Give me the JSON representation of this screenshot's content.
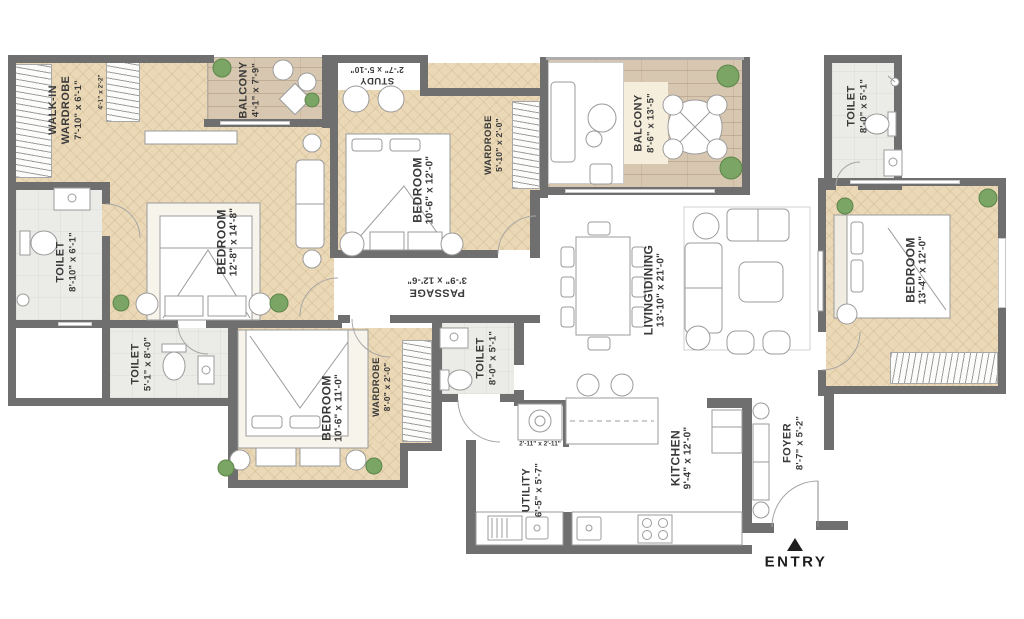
{
  "palette": {
    "wall": "#6f6f6f",
    "wood": "#ead8b6",
    "deck": "#d8c7b0",
    "tile": "#ebebe7",
    "cream": "#f5eedc",
    "plant": "#7aa564",
    "ink": "#3a3a3a"
  },
  "rooms": {
    "walk_in_wardrobe": {
      "name": "WALK-IN\nWARDROBE",
      "dims": "7'-10\" x 6'-1\""
    },
    "wiw_closet": {
      "dims": "4'-1\" x 2'-2\""
    },
    "toilet_master": {
      "name": "TOILET",
      "dims": "8'-10\" x 6'-1\""
    },
    "bedroom_master": {
      "name": "BEDROOM",
      "dims": "12'-8\" x 14'-8\""
    },
    "balcony_1": {
      "name": "BALCONY",
      "dims": "4'-1\" x 7'-9\""
    },
    "study": {
      "name": "STUDY",
      "dims": "2'-7\" x 5'-10\""
    },
    "bedroom_2": {
      "name": "BEDROOM",
      "dims": "10'-6\" x 12'-0\""
    },
    "wardrobe_2": {
      "name": "WARDROBE",
      "dims": "5'-10\" x 2'-0\""
    },
    "balcony_2": {
      "name": "BALCONY",
      "dims": "8'-6\" x 13'-5\""
    },
    "toilet_top_right": {
      "name": "TOILET",
      "dims": "8'-0\" x 5'-1\""
    },
    "bedroom_3": {
      "name": "BEDROOM",
      "dims": "13'-4\" x 12'-0\""
    },
    "living_dining": {
      "name": "LIVING\\DINING",
      "dims": "13'-10\" x 21'-0\""
    },
    "passage": {
      "name": "PASSAGE",
      "dims": "3'-9\" x 12'-6\""
    },
    "toilet_3": {
      "name": "TOILET",
      "dims": "5'-1\" x 8'-0\""
    },
    "bedroom_4": {
      "name": "BEDROOM",
      "dims": "10'-6\" x 11'-0\""
    },
    "wardrobe_4": {
      "name": "WARDROBE",
      "dims": "8'-0\" x 2'-0\""
    },
    "toilet_4": {
      "name": "TOILET",
      "dims": "8'-0\" x 5'-1\""
    },
    "washer_nook": {
      "dims": "2'-11\" x 2'-11\""
    },
    "utility": {
      "name": "UTILITY",
      "dims": "6'-5\" x 5'-7\""
    },
    "kitchen": {
      "name": "KITCHEN",
      "dims": "9'-4\" x 12'-0\""
    },
    "foyer": {
      "name": "FOYER",
      "dims": "8'-7\" x 5'-2\""
    },
    "entry": {
      "label": "ENTRY"
    }
  }
}
